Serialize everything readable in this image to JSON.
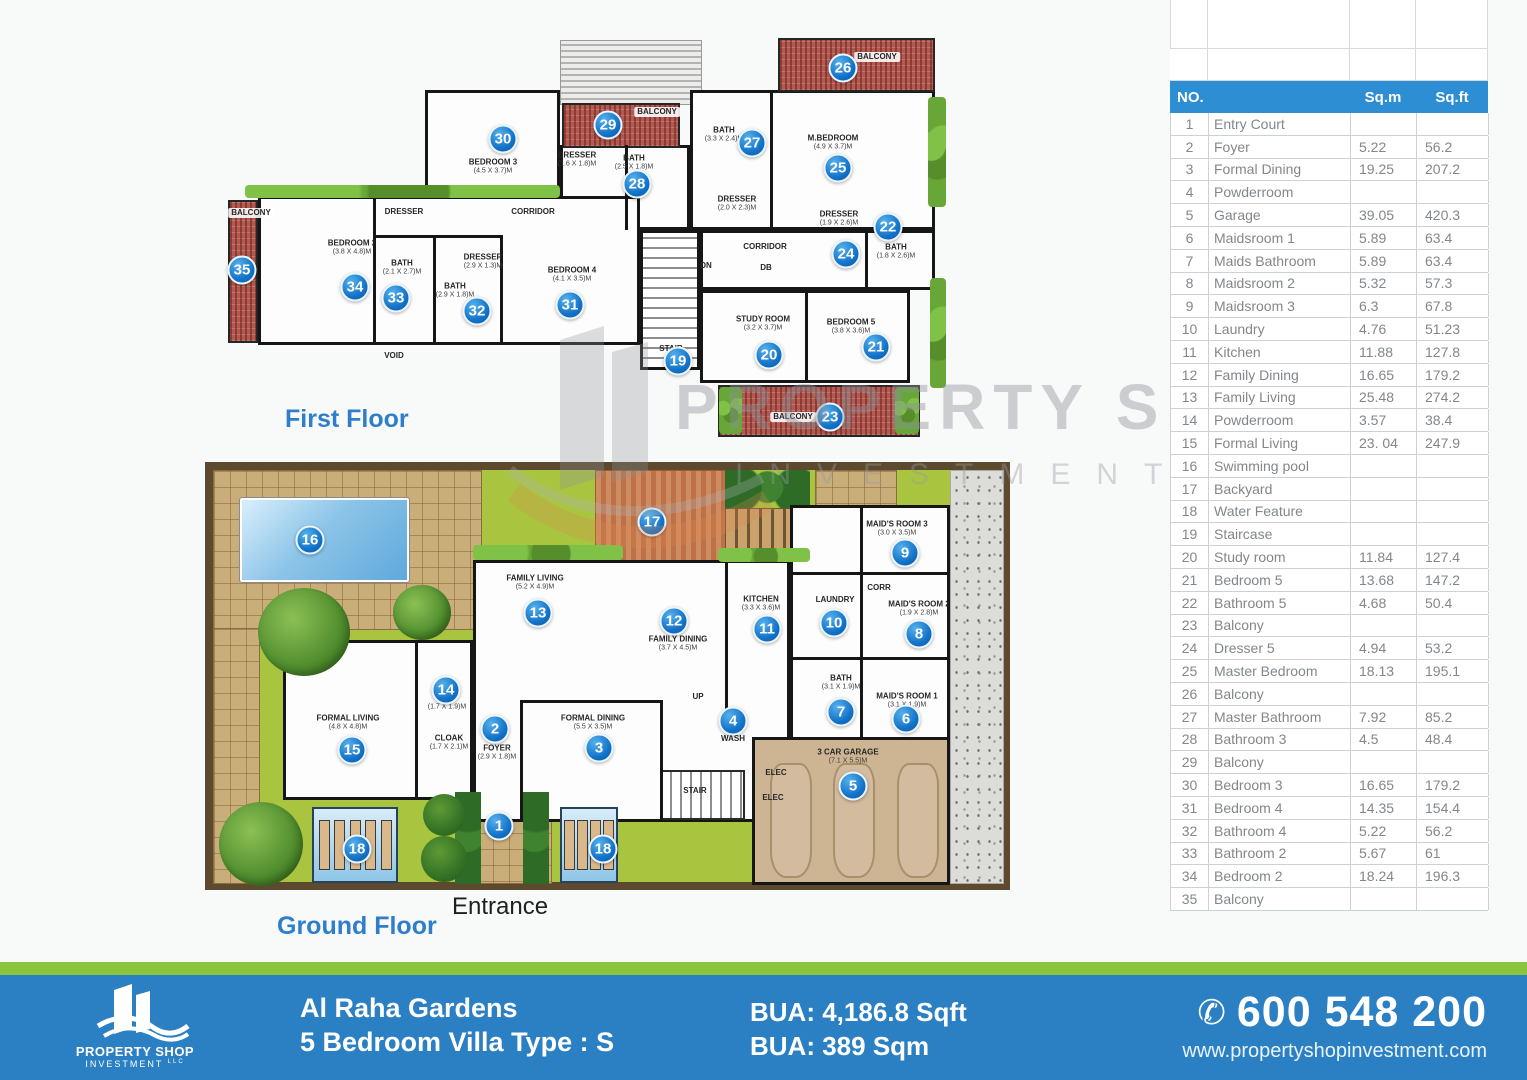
{
  "watermark": {
    "line1": "PROPERTY SHOP",
    "line2": "INVESTMENT",
    "line3": "LLC"
  },
  "floors": {
    "first_title": "First Floor",
    "ground_title": "Ground Floor",
    "entrance": "Entrance"
  },
  "colors": {
    "accent_blue": "#2b80c4",
    "table_header_blue": "#2e8ed3",
    "footer_green": "#8bc53f",
    "marker_blue": "#1272c8",
    "balcony_red": "#b05a51",
    "garden_green": "#a9c53f"
  },
  "table": {
    "no_header": "NO.",
    "sqm_header": "Sq.m",
    "sqft_header": "Sq.ft",
    "rows": [
      [
        "1",
        "Entry Court",
        "",
        ""
      ],
      [
        "2",
        "Foyer",
        "5.22",
        "56.2"
      ],
      [
        "3",
        "Formal Dining",
        "19.25",
        "207.2"
      ],
      [
        "4",
        "Powderroom",
        "",
        ""
      ],
      [
        "5",
        "Garage",
        "39.05",
        "420.3"
      ],
      [
        "6",
        "Maidsroom 1",
        "5.89",
        "63.4"
      ],
      [
        "7",
        "Maids Bathroom",
        "5.89",
        "63.4"
      ],
      [
        "8",
        "Maidsroom 2",
        "5.32",
        "57.3"
      ],
      [
        "9",
        "Maidsroom 3",
        "6.3",
        "67.8"
      ],
      [
        "10",
        "Laundry",
        "4.76",
        "51.23"
      ],
      [
        "11",
        "Kitchen",
        "11.88",
        "127.8"
      ],
      [
        "12",
        "Family Dining",
        "16.65",
        "179.2"
      ],
      [
        "13",
        "Family Living",
        "25.48",
        "274.2"
      ],
      [
        "14",
        "Powderroom",
        "3.57",
        "38.4"
      ],
      [
        "15",
        "Formal Living",
        "23. 04",
        "247.9"
      ],
      [
        "16",
        "Swimming pool",
        "",
        ""
      ],
      [
        "17",
        "Backyard",
        "",
        ""
      ],
      [
        "18",
        "Water Feature",
        "",
        ""
      ],
      [
        "19",
        "Staircase",
        "",
        ""
      ],
      [
        "20",
        "Study room",
        "11.84",
        "127.4"
      ],
      [
        "21",
        "Bedroom 5",
        "13.68",
        "147.2"
      ],
      [
        "22",
        "Bathroom 5",
        "4.68",
        "50.4"
      ],
      [
        "23",
        "Balcony",
        "",
        ""
      ],
      [
        "24",
        "Dresser 5",
        "4.94",
        "53.2"
      ],
      [
        "25",
        "Master Bedroom",
        "18.13",
        "195.1"
      ],
      [
        "26",
        "Balcony",
        "",
        ""
      ],
      [
        "27",
        "Master Bathroom",
        "7.92",
        "85.2"
      ],
      [
        "28",
        "Bathroom 3",
        "4.5",
        "48.4"
      ],
      [
        "29",
        "Balcony",
        "",
        ""
      ],
      [
        "30",
        "Bedroom 3",
        "16.65",
        "179.2"
      ],
      [
        "31",
        "Bedroom 4",
        "14.35",
        "154.4"
      ],
      [
        "32",
        "Bathroom 4",
        "5.22",
        "56.2"
      ],
      [
        "33",
        "Bathroom 2",
        "5.67",
        "61"
      ],
      [
        "34",
        "Bedroom 2",
        "18.24",
        "196.3"
      ],
      [
        "35",
        "Balcony",
        "",
        ""
      ]
    ]
  },
  "first_floor": {
    "items": [
      {
        "id": "balcony35",
        "marker": 35,
        "name": "BALCONY"
      },
      {
        "id": "bedroom2",
        "marker": 34,
        "name": "BEDROOM 2",
        "dims": "(3.8 x 4.8)m"
      },
      {
        "id": "bath33",
        "marker": 33,
        "name": "BATH",
        "dims": "(2.1 x 2.7)m"
      },
      {
        "id": "bath32",
        "marker": 32,
        "name": "BATH",
        "dims": "(2.9 x 1.8)m"
      },
      {
        "id": "bedroom4",
        "marker": 31,
        "name": "BEDROOM 4",
        "dims": "(4.1 x 3.5)m"
      },
      {
        "id": "bedroom3",
        "marker": 30,
        "name": "BEDROOM 3",
        "dims": "(4.5 x 3.7)m"
      },
      {
        "id": "balcony29",
        "marker": 29,
        "name": "BALCONY"
      },
      {
        "id": "bath28",
        "marker": 28,
        "name": "BATH",
        "dims": "(2.5 x 1.8)m"
      },
      {
        "id": "bath27",
        "marker": 27,
        "name": "BATH",
        "dims": "(3.3 x 2.4)m"
      },
      {
        "id": "mbedroom",
        "marker": 25,
        "name": "M.BEDROOM",
        "dims": "(4.9 x 3.7)m"
      },
      {
        "id": "balcony26",
        "marker": 26,
        "name": "BALCONY"
      },
      {
        "id": "dresser24",
        "marker": 24,
        "name": "DRESSER",
        "dims": "(1.9 x 2.6)m"
      },
      {
        "id": "bath22",
        "marker": 22,
        "name": "BATH",
        "dims": "(1.8 x 2.6)m"
      },
      {
        "id": "stair19",
        "marker": 19,
        "name": "STAIR"
      },
      {
        "id": "study20",
        "marker": 20,
        "name": "STUDY ROOM",
        "dims": "(3.2 x 3.7)m"
      },
      {
        "id": "bedroom5",
        "marker": 21,
        "name": "BEDROOM 5",
        "dims": "(3.8 x 3.6)m"
      },
      {
        "id": "balcony23",
        "marker": 23,
        "name": "BALCONY"
      },
      {
        "id": "ff-dresser-a",
        "name": "DRESSER",
        "dims": "(1.6 x 1.8)m"
      },
      {
        "id": "ff-dresser-b",
        "name": "DRESSER",
        "dims": "(2.0 x 2.3)m"
      },
      {
        "id": "ff-dresser-c",
        "name": "DRESSER",
        "dims": "(2.9 x 1.3)m"
      },
      {
        "id": "ff-dresser-d",
        "name": "DRESSER"
      },
      {
        "id": "ff-corridor-a",
        "name": "CORRIDOR"
      },
      {
        "id": "ff-corridor-b",
        "name": "CORRIDOR"
      },
      {
        "id": "ff-void",
        "name": "VOID"
      },
      {
        "id": "ff-dn",
        "name": "DN"
      },
      {
        "id": "ff-db",
        "name": "DB"
      }
    ]
  },
  "ground_floor": {
    "items": [
      {
        "id": "entry1",
        "marker": 1
      },
      {
        "id": "foyer",
        "marker": 2,
        "name": "FOYER",
        "dims": "(2.9 x 1.8)m"
      },
      {
        "id": "formal-dining",
        "marker": 3,
        "name": "FORMAL DINING",
        "dims": "(5.5 x 3.5)m"
      },
      {
        "id": "wash",
        "marker": 4,
        "name": "WASH"
      },
      {
        "id": "garage",
        "marker": 5,
        "name": "3 CAR GARAGE",
        "dims": "(7.1 x 5.5)m"
      },
      {
        "id": "maid1",
        "marker": 6,
        "name": "MAID'S ROOM 1",
        "dims": "(3.1 x 1.9)m"
      },
      {
        "id": "bath7",
        "marker": 7,
        "name": "BATH",
        "dims": "(3.1 x 1.9)m"
      },
      {
        "id": "maid2",
        "marker": 8,
        "name": "MAID'S ROOM 2",
        "dims": "(1.9 x 2.8)m"
      },
      {
        "id": "maid3",
        "marker": 9,
        "name": "MAID'S ROOM 3",
        "dims": "(3.0 x 3.5)m"
      },
      {
        "id": "laundry",
        "marker": 10,
        "name": "LAUNDRY"
      },
      {
        "id": "kitchen",
        "marker": 11,
        "name": "KITCHEN",
        "dims": "(3.3 x 3.6)m"
      },
      {
        "id": "family-dining",
        "marker": 12,
        "name": "FAMILY DINING",
        "dims": "(3.7 x 4.5)m"
      },
      {
        "id": "family-living",
        "marker": 13,
        "name": "FAMILY LIVING",
        "dims": "(5.2 x 4.9)m"
      },
      {
        "id": "powder14",
        "marker": 14,
        "dims": "(1.7 x 1.9)m"
      },
      {
        "id": "formal-living",
        "marker": 15,
        "name": "FORMAL LIVING",
        "dims": "(4.8 x 4.8)m"
      },
      {
        "id": "pool16",
        "marker": 16
      },
      {
        "id": "backyard17",
        "marker": 17
      },
      {
        "id": "wf-left",
        "marker": 18
      },
      {
        "id": "wf-right",
        "marker": 18
      },
      {
        "id": "cloak",
        "name": "CLOAK",
        "dims": "(1.7 x 2.1)m"
      },
      {
        "id": "gf-corr",
        "name": "CORR"
      },
      {
        "id": "gf-stair",
        "name": "STAIR"
      },
      {
        "id": "gf-up",
        "name": "UP"
      },
      {
        "id": "gf-elec-a",
        "name": "ELEC"
      },
      {
        "id": "gf-elec-b",
        "name": "ELEC"
      }
    ]
  },
  "footer": {
    "project": "Al Raha Gardens",
    "subtitle": "5 Bedroom Villa Type : S",
    "bua_sqft": "BUA: 4,186.8 Sqft",
    "bua_sqm": "BUA: 389 Sqm",
    "phone": "600 548 200",
    "website": "www.propertyshopinvestment.com",
    "logo_title": "PROPERTY SHOP",
    "logo_sub": "INVESTMENT",
    "logo_llc": "LLC"
  }
}
